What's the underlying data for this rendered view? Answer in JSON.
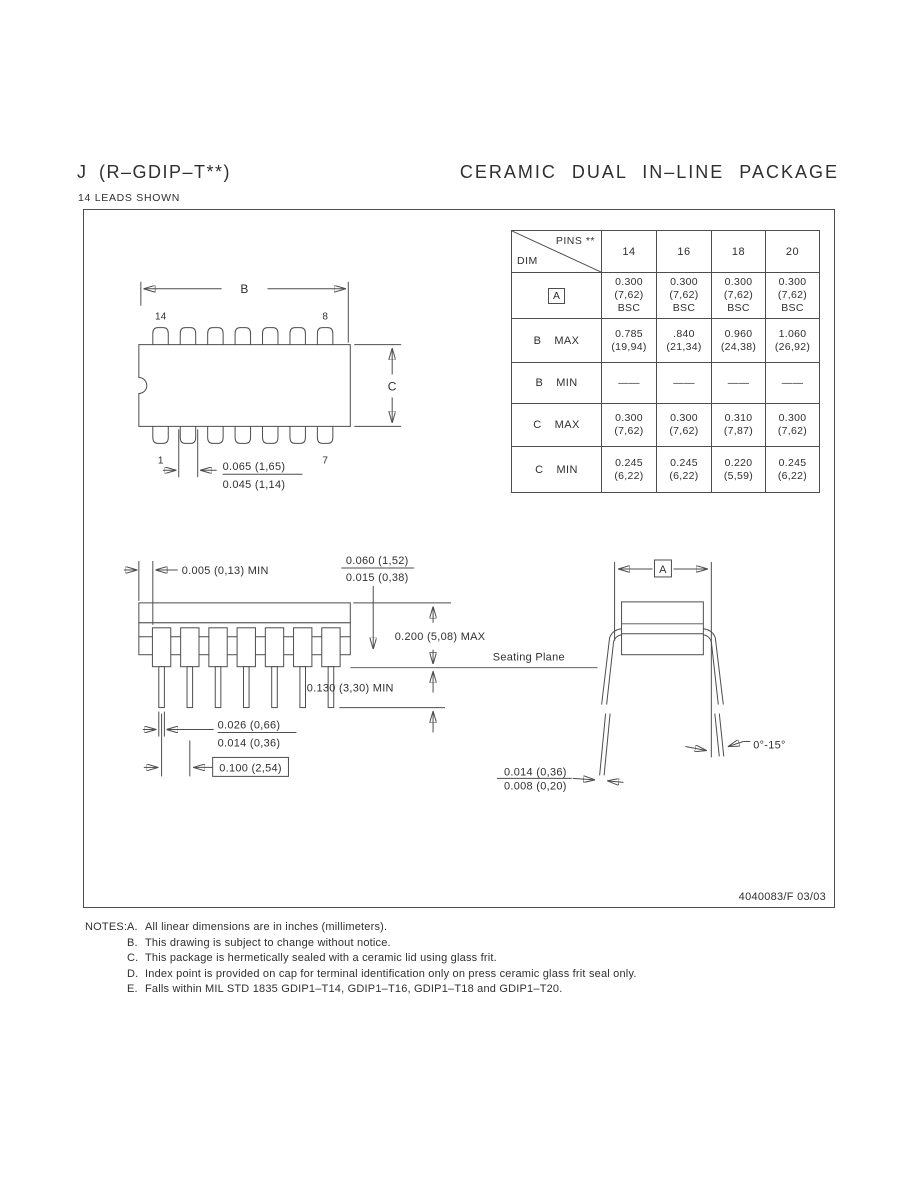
{
  "page": {
    "title_left": "J (R–GDIP–T**)",
    "subtitle_left": "14 LEADS SHOWN",
    "title_right": "CERAMIC DUAL IN–LINE PACKAGE",
    "doc_number": "4040083/F 03/03"
  },
  "table": {
    "corner_top": "PINS **",
    "corner_bottom": "DIM",
    "columns": [
      "14",
      "16",
      "18",
      "20"
    ],
    "rows": [
      {
        "label": "A",
        "qualifier": "",
        "cells": [
          [
            "0.300",
            "(7,62)",
            "BSC"
          ],
          [
            "0.300",
            "(7,62)",
            "BSC"
          ],
          [
            "0.300",
            "(7,62)",
            "BSC"
          ],
          [
            "0.300",
            "(7,62)",
            "BSC"
          ]
        ]
      },
      {
        "label": "B",
        "qualifier": "MAX",
        "cells": [
          [
            "0.785",
            "(19,94)"
          ],
          [
            ".840",
            "(21,34)"
          ],
          [
            "0.960",
            "(24,38)"
          ],
          [
            "1.060",
            "(26,92)"
          ]
        ]
      },
      {
        "label": "B",
        "qualifier": "MIN",
        "cells": [
          [
            "——"
          ],
          [
            "——"
          ],
          [
            "——"
          ],
          [
            "——"
          ]
        ]
      },
      {
        "label": "C",
        "qualifier": "MAX",
        "cells": [
          [
            "0.300",
            "(7,62)"
          ],
          [
            "0.300",
            "(7,62)"
          ],
          [
            "0.310",
            "(7,87)"
          ],
          [
            "0.300",
            "(7,62)"
          ]
        ]
      },
      {
        "label": "C",
        "qualifier": "MIN",
        "cells": [
          [
            "0.245",
            "(6,22)"
          ],
          [
            "0.245",
            "(6,22)"
          ],
          [
            "0.220",
            "(5,59)"
          ],
          [
            "0.245",
            "(6,22)"
          ]
        ]
      }
    ]
  },
  "top_view": {
    "dim_b": "B",
    "dim_c": "C",
    "pin_top_left": "14",
    "pin_top_right": "8",
    "pin_bottom_left": "1",
    "pin_bottom_right": "7",
    "lead_width_max": "0.065 (1,65)",
    "lead_width_min": "0.045 (1,14)"
  },
  "side_view": {
    "standoff": "0.005 (0,13) MIN",
    "lid_max": "0.060 (1,52)",
    "lid_min": "0.015 (0,38)",
    "body_height": "0.200 (5,08) MAX",
    "seating_plane": "Seating Plane",
    "lead_length": "0.130 (3,30) MIN",
    "tip_width_max": "0.026 (0,66)",
    "tip_width_min": "0.014 (0,36)",
    "lead_pitch": "0.100 (2,54)"
  },
  "end_view": {
    "dim_a": "A",
    "lead_thickness_max": "0.014 (0,36)",
    "lead_thickness_min": "0.008 (0,20)",
    "lead_angle": "0°-15°"
  },
  "notes": {
    "label": "NOTES:",
    "items": [
      {
        "letter": "A.",
        "text": "All linear dimensions are in inches (millimeters)."
      },
      {
        "letter": "B.",
        "text": "This drawing is subject to change without notice."
      },
      {
        "letter": "C.",
        "text": "This package is hermetically sealed with a ceramic lid using glass frit."
      },
      {
        "letter": "D.",
        "text": "Index point is provided on cap for terminal identification only on press ceramic glass frit seal only."
      },
      {
        "letter": "E.",
        "text": "Falls within MIL STD 1835 GDIP1–T14, GDIP1–T16, GDIP1–T18 and GDIP1–T20."
      }
    ]
  }
}
